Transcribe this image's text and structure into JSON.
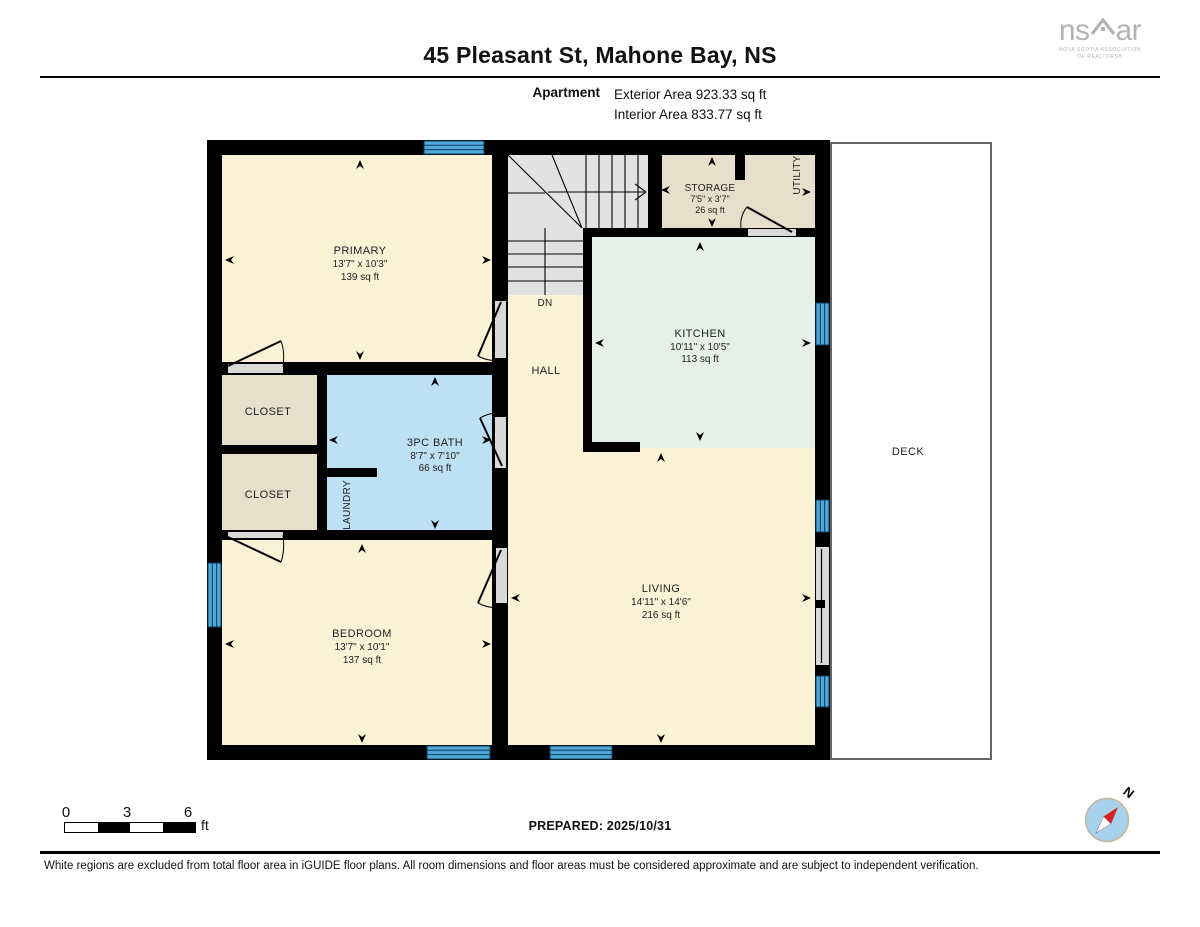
{
  "header": {
    "title": "45 Pleasant St, Mahone Bay, NS",
    "floor_label": "Apartment",
    "exterior_area": "Exterior Area 923.33 sq ft",
    "interior_area": "Interior Area 833.77 sq ft",
    "logo": {
      "left": "ns",
      "right": "ar",
      "sub_line1": "NOVA SCOTIA ASSOCIATION",
      "sub_line2": "OF REALTORS®"
    }
  },
  "plan": {
    "primary": {
      "name": "PRIMARY",
      "dims": "13'7\" x 10'3\"",
      "area": "139 sq ft"
    },
    "storage": {
      "name": "STORAGE",
      "dims": "7'5\" x 3'7\"",
      "area": "26 sq ft"
    },
    "utility": {
      "name": "UTILITY"
    },
    "kitchen": {
      "name": "KITCHEN",
      "dims": "10'11\" x 10'5\"",
      "area": "113 sq ft"
    },
    "hall": {
      "name": "HALL"
    },
    "stairs": {
      "down_label": "DN"
    },
    "closet1": {
      "name": "CLOSET"
    },
    "closet2": {
      "name": "CLOSET"
    },
    "bath": {
      "name": "3PC BATH",
      "dims": "8'7\" x 7'10\"",
      "area": "66 sq ft"
    },
    "laundry": {
      "name": "LAUNDRY"
    },
    "bedroom": {
      "name": "BEDROOM",
      "dims": "13'7\" x 10'1\"",
      "area": "137 sq ft"
    },
    "living": {
      "name": "LIVING",
      "dims": "14'11\" x 14'6\"",
      "area": "216 sq ft"
    },
    "deck": {
      "name": "DECK"
    }
  },
  "colors": {
    "wall": "#000000",
    "room_cream": "#FBF1D5",
    "room_tan": "#E7DFCC",
    "room_mint": "#E5F0E9",
    "room_blue": "#BEE0F4",
    "stairs_gray": "#E2E2E2",
    "window_blue": "#4FA8D8",
    "door_panel": "#D9D9D9",
    "deck_border": "#666666",
    "compass_face": "#A8D2EC",
    "needle_red": "#D62020"
  },
  "footer": {
    "scale": {
      "tick0": "0",
      "tick3": "3",
      "tick6": "6",
      "unit": "ft"
    },
    "prepared": "PREPARED: 2025/10/31",
    "compass_label": "N",
    "disclaimer": "White regions are excluded from total floor area in iGUIDE floor plans. All room dimensions and floor areas must be considered approximate and are subject to independent verification."
  }
}
